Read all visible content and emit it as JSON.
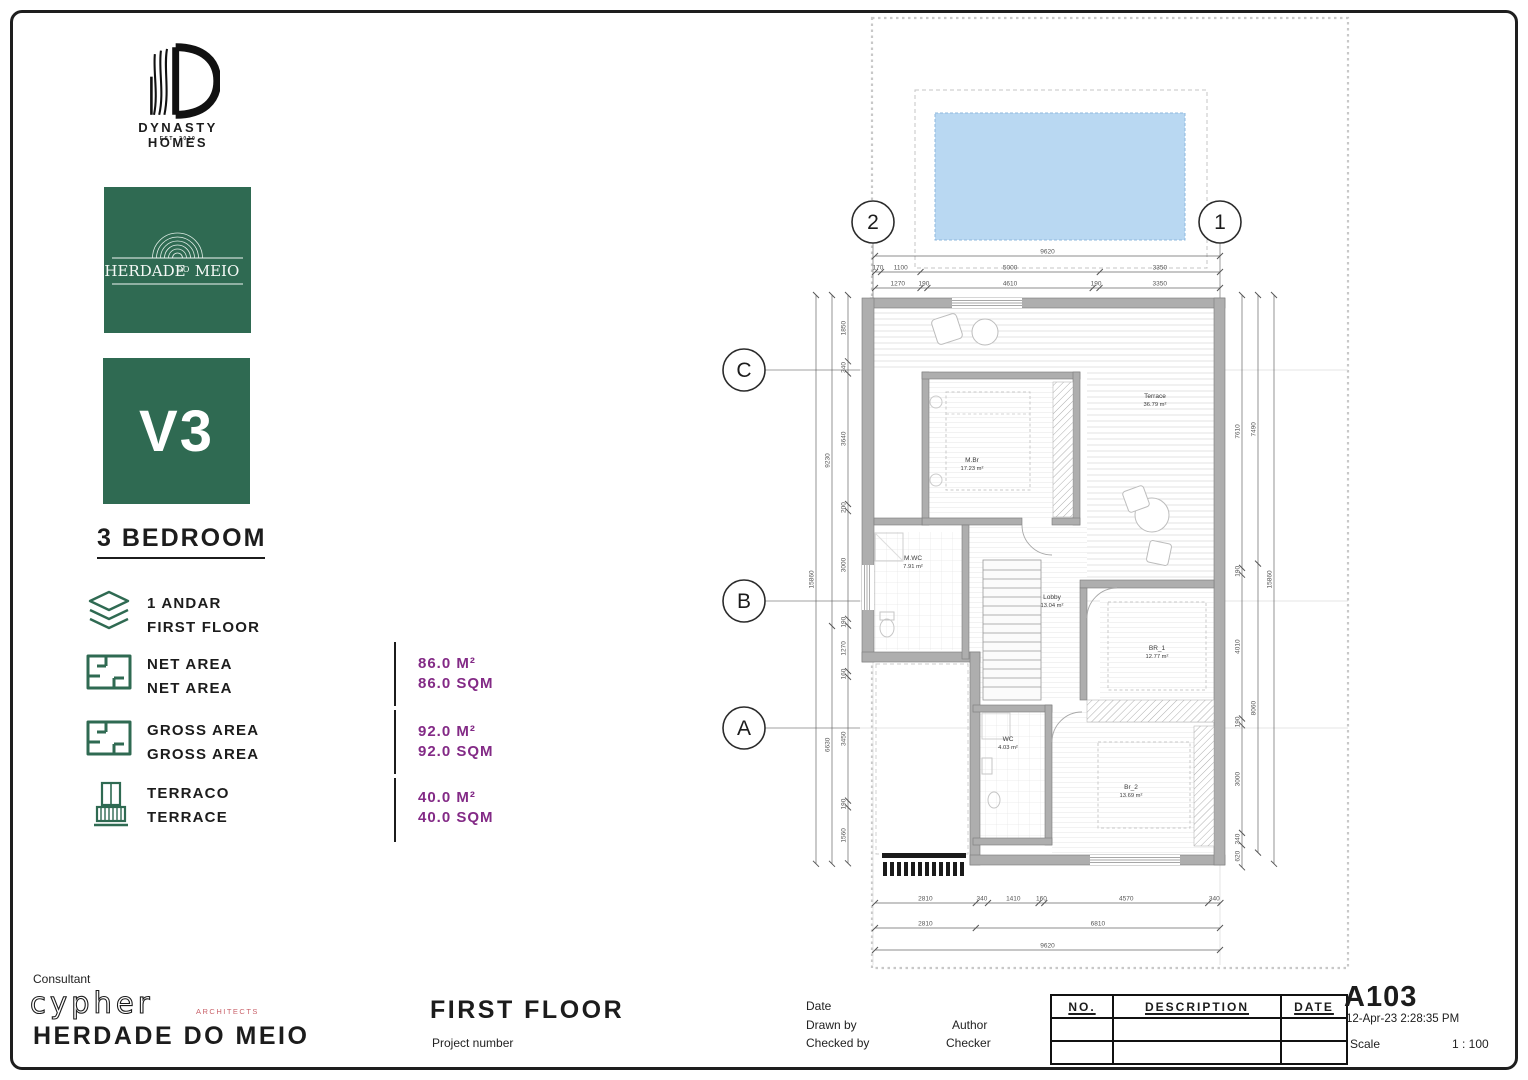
{
  "brand": {
    "name": "DYNASTY HOMES",
    "established": "EST. 2020"
  },
  "development": {
    "logo_word1": "HERDADE",
    "logo_word2": "DO",
    "logo_word3": "MEIO",
    "unit": "V3",
    "type": "3 BEDROOM"
  },
  "features": {
    "floor": {
      "label_pt": "1 ANDAR",
      "label_en": "FIRST FLOOR"
    },
    "net": {
      "label_pt": "NET AREA",
      "label_en": "NET AREA",
      "value_m2": "86.0 M²",
      "value_sqm": "86.0 SQM"
    },
    "gross": {
      "label_pt": "GROSS AREA",
      "label_en": "GROSS AREA",
      "value_m2": "92.0 M²",
      "value_sqm": "92.0 SQM"
    },
    "terrace": {
      "label_pt": "TERRACO",
      "label_en": "TERRACE",
      "value_m2": "40.0 M²",
      "value_sqm": "40.0 SQM"
    }
  },
  "titleblock": {
    "consultant_label": "Consultant",
    "consultant_name": "cypher",
    "consultant_sub": "ARCHITECTS",
    "project": "HERDADE DO MEIO",
    "view": "FIRST FLOOR",
    "project_number_label": "Project number",
    "date_label": "Date",
    "drawn_label": "Drawn by",
    "drawn_value": "Author",
    "checked_label": "Checked by",
    "checked_value": "Checker",
    "rev_no": "NO.",
    "rev_desc": "DESCRIPTION",
    "rev_date": "DATE",
    "sheet_no": "A103",
    "timestamp": "12-Apr-23 2:28:35 PM",
    "scale_label": "Scale",
    "scale_value": "1 : 100"
  },
  "plan": {
    "grid": {
      "c1": "1",
      "c2": "2",
      "ra": "A",
      "rb": "B",
      "rc": "C"
    },
    "rooms": {
      "terrace": {
        "name": "Terrace",
        "area": "36.79 m²"
      },
      "mbr": {
        "name": "M.Br",
        "area": "17.23 m²"
      },
      "mwc": {
        "name": "M.WC",
        "area": "7.91 m²"
      },
      "lobby": {
        "name": "Lobby",
        "area": "13.04 m²"
      },
      "br1": {
        "name": "BR_1",
        "area": "12.77 m²"
      },
      "wc": {
        "name": "WC",
        "area": "4.03 m²"
      },
      "br2": {
        "name": "Br_2",
        "area": "13.69 m²"
      }
    },
    "dims": {
      "top1": [
        "9620"
      ],
      "top2": [
        "170",
        "1100",
        "5000",
        "3350"
      ],
      "top3": [
        "1270",
        "190",
        "4610",
        "190",
        "3350"
      ],
      "left_outer": [
        "15860"
      ],
      "left_mid": [
        "9230",
        "6630"
      ],
      "left_inner": [
        "1850",
        "340",
        "3640",
        "200",
        "3000",
        "190",
        "1270",
        "160",
        "3450",
        "190",
        "1560"
      ],
      "right_inner": [
        "7610",
        "190",
        "4010",
        "190",
        "3000",
        "340",
        "620"
      ],
      "right_mid": [
        "7490",
        "8060"
      ],
      "right_outer": [
        "15860"
      ],
      "bottom1": [
        "2810",
        "340",
        "1410",
        "160",
        "4570",
        "340"
      ],
      "bottom2": [
        "2810",
        "6810"
      ],
      "bottom3": [
        "9620"
      ]
    }
  }
}
